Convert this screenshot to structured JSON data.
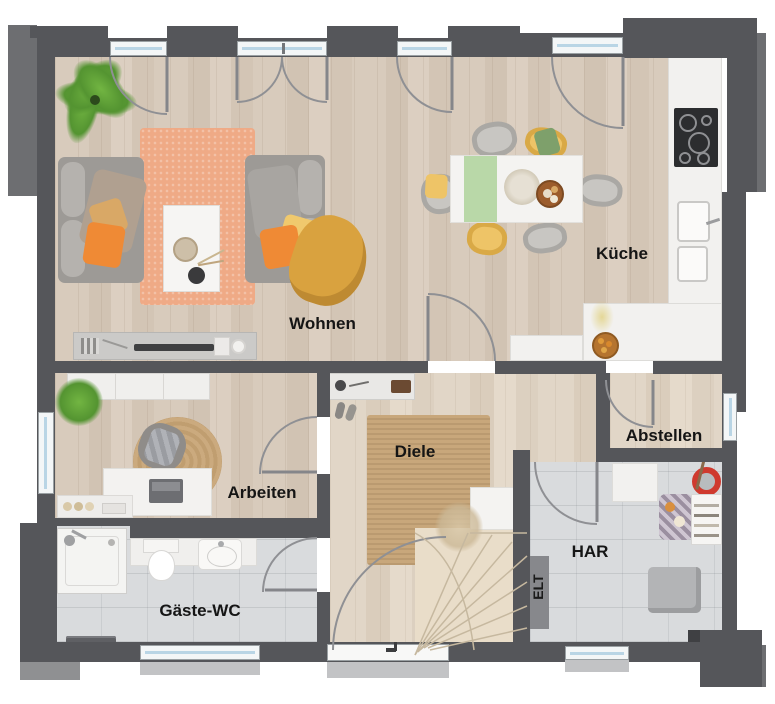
{
  "rooms": {
    "wohnen": {
      "label": "Wohnen"
    },
    "kueche": {
      "label": "Küche"
    },
    "arbeiten": {
      "label": "Arbeiten"
    },
    "diele": {
      "label": "Diele"
    },
    "abstellen": {
      "label": "Abstellen"
    },
    "har": {
      "label": "HAR"
    },
    "elt": {
      "label": "ELT"
    },
    "gaeste_wc": {
      "label": "Gäste-WC"
    }
  },
  "colors": {
    "wall": "#55565a",
    "wood_floor": "#d5c8b9",
    "wood_floor_light": "#e0d5c6",
    "tile_floor": "#d9dbdd",
    "rug_orange": "#efaa86",
    "rug_jute": "#c8a77b",
    "pillow_orange": "#ef8a35",
    "chair_yellow": "#eec467",
    "runner_green": "#b9d8a8",
    "plant_green": "#5fa436",
    "bucket_red": "#cf3a2e",
    "window_glass": "#b9d5e5"
  }
}
